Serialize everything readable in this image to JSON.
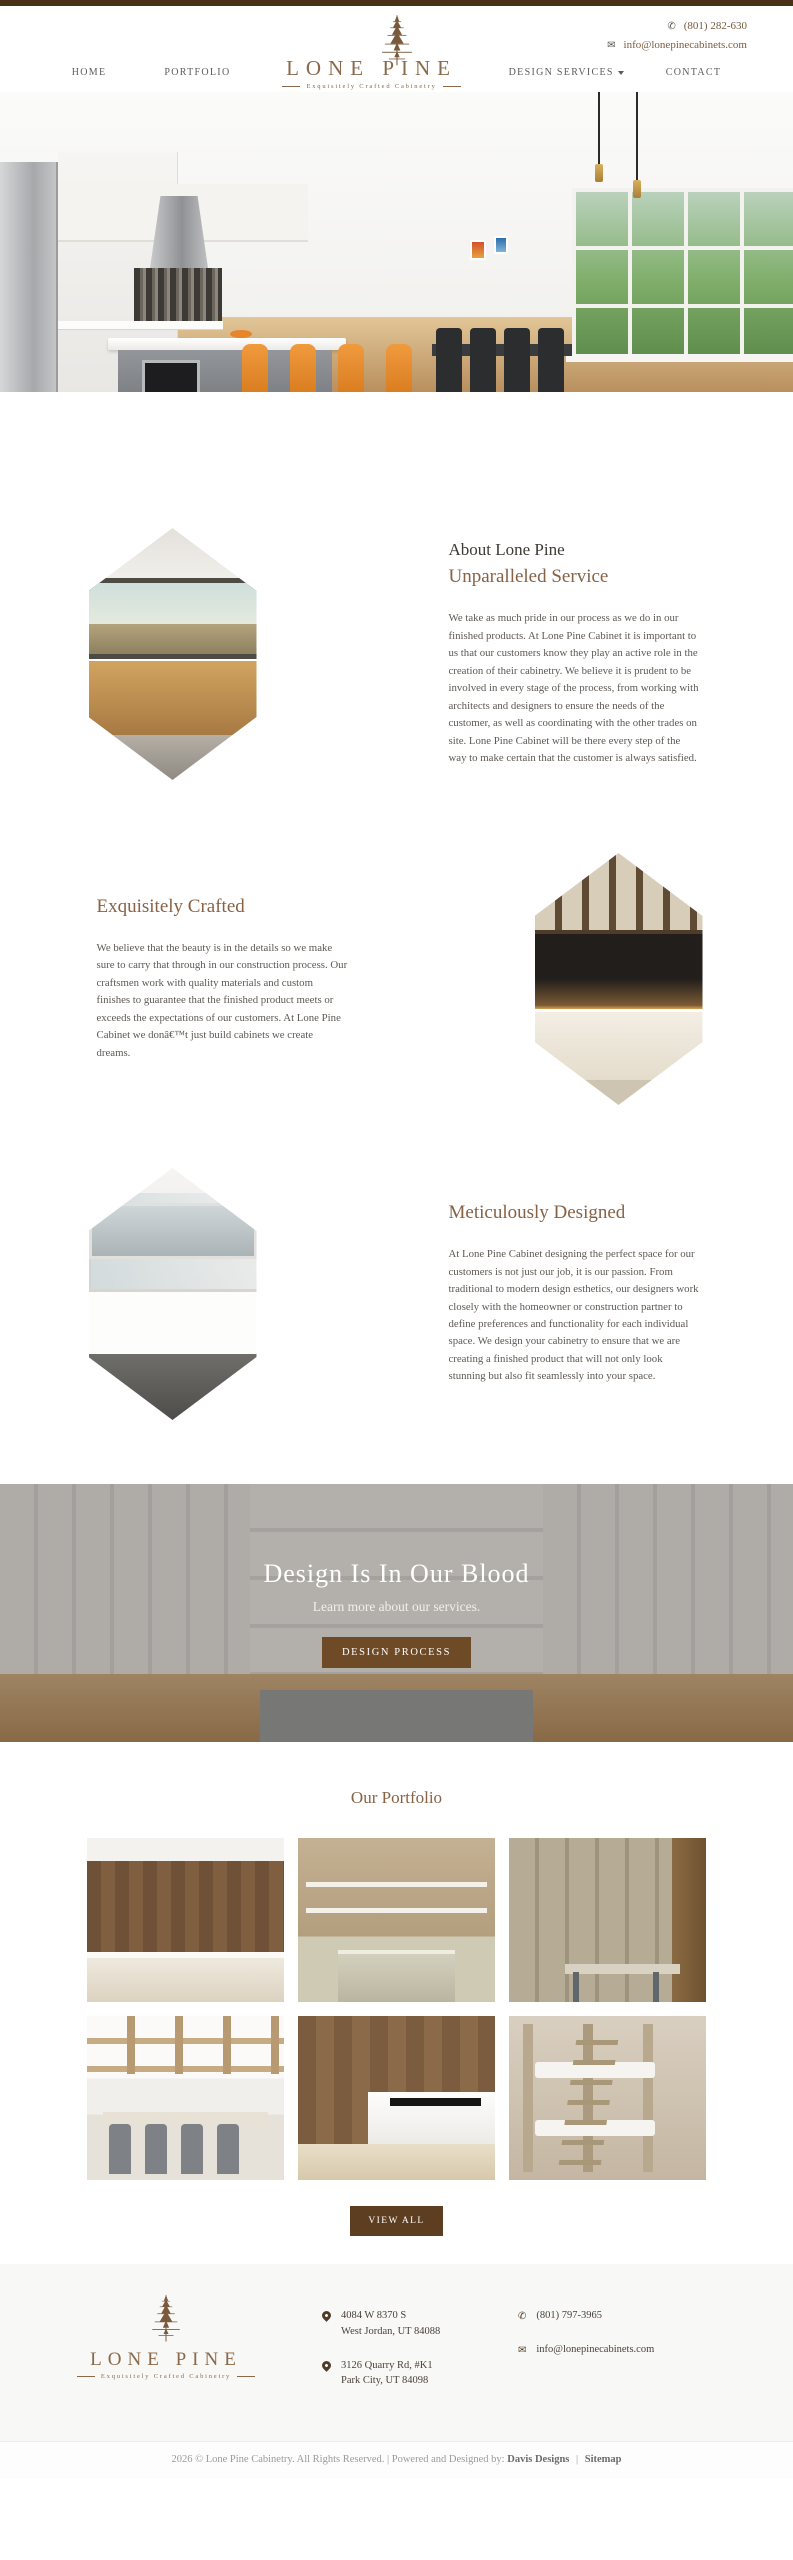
{
  "header": {
    "phone": "(801) 282-630",
    "email": "info@lonepinecabinets.com",
    "nav": {
      "home": "HOME",
      "portfolio": "PORTFOLIO",
      "design_services": "DESIGN SERVICES",
      "contact": "CONTACT"
    },
    "logo": {
      "name": "LONE PINE",
      "tagline": "Exquisitely Crafted Cabinetry"
    }
  },
  "icons": {
    "phone_glyph": "✆",
    "email_glyph": "✉"
  },
  "hero": {
    "image_alt": "modern-kitchen-with-orange-bar-stools"
  },
  "about": {
    "section1": {
      "eyebrow": "About Lone Pine",
      "title": "Unparalleled Service",
      "body": "We take as much pride in our process as we do in our finished products. At Lone Pine Cabinet it is important to us that our customers know they play an active role in the creation of their cabinetry. We believe it is prudent to be involved in every stage of the process, from working with architects and designers to ensure the needs of the customer, as well as coordinating with the other trades on site. Lone Pine Cabinet will be there every step of the way to make certain that the customer is always satisfied.",
      "image": "kitchen-window-view-hexagon"
    },
    "section2": {
      "title": "Exquisitely Crafted",
      "body": "We believe that the beauty is in the details so we make sure to carry that through in our construction process. Our craftsmen work with quality materials and custom finishes to guarantee that the finished product meets or exceeds the expectations of our customers. At Lone Pine Cabinet we donâ€™t just build cabinets we create dreams.",
      "image": "dark-backsplash-kitchen-hexagon"
    },
    "section3": {
      "title": "Meticulously Designed",
      "body": "At Lone Pine Cabinet designing the perfect space for our customers is not just our job, it is our passion. From traditional to modern design esthetics, our designers work closely with the homeowner or construction partner to define preferences and functionality for each individual space. We design your cabinetry to ensure that we are creating a finished product that will not only look stunning but also fit seamlessly into your space.",
      "image": "white-bathroom-vanity-hexagon"
    }
  },
  "banner": {
    "title": "Design Is In Our Blood",
    "subtitle": "Learn more about our services.",
    "button_label": "DESIGN PROCESS",
    "image_alt": "white-kitchen-background"
  },
  "portfolio": {
    "title": "Our Portfolio",
    "view_all_label": "VIEW ALL",
    "items": [
      {
        "name": "modern-walnut-kitchen"
      },
      {
        "name": "rustic-open-shelving-kitchen"
      },
      {
        "name": "mudroom-lockers-with-bench"
      },
      {
        "name": "coffered-ceiling-kitchen-bar"
      },
      {
        "name": "dark-wood-kitchen-island"
      },
      {
        "name": "custom-bunk-beds"
      }
    ]
  },
  "footer": {
    "logo": {
      "name": "LONE PINE",
      "tagline": "Exquisitely Crafted Cabinetry"
    },
    "address1": {
      "line1": "4084 W 8370 S",
      "line2": "West Jordan, UT 84088"
    },
    "address2": {
      "line1": "3126 Quarry Rd, #K1",
      "line2": "Park City, UT 84098"
    },
    "phone": "(801) 797-3965",
    "email": "info@lonepinecabinets.com"
  },
  "copyright": {
    "text": "2026 © Lone Pine Cabinetry. All Rights Reserved. | Powered and Designed by:",
    "link1": "Davis Designs",
    "separator": "|",
    "link2": "Sitemap"
  },
  "colors": {
    "accent_brown": "#8a6a4a",
    "dark_brown": "#4a3018",
    "button_brown": "#6e4a26"
  }
}
